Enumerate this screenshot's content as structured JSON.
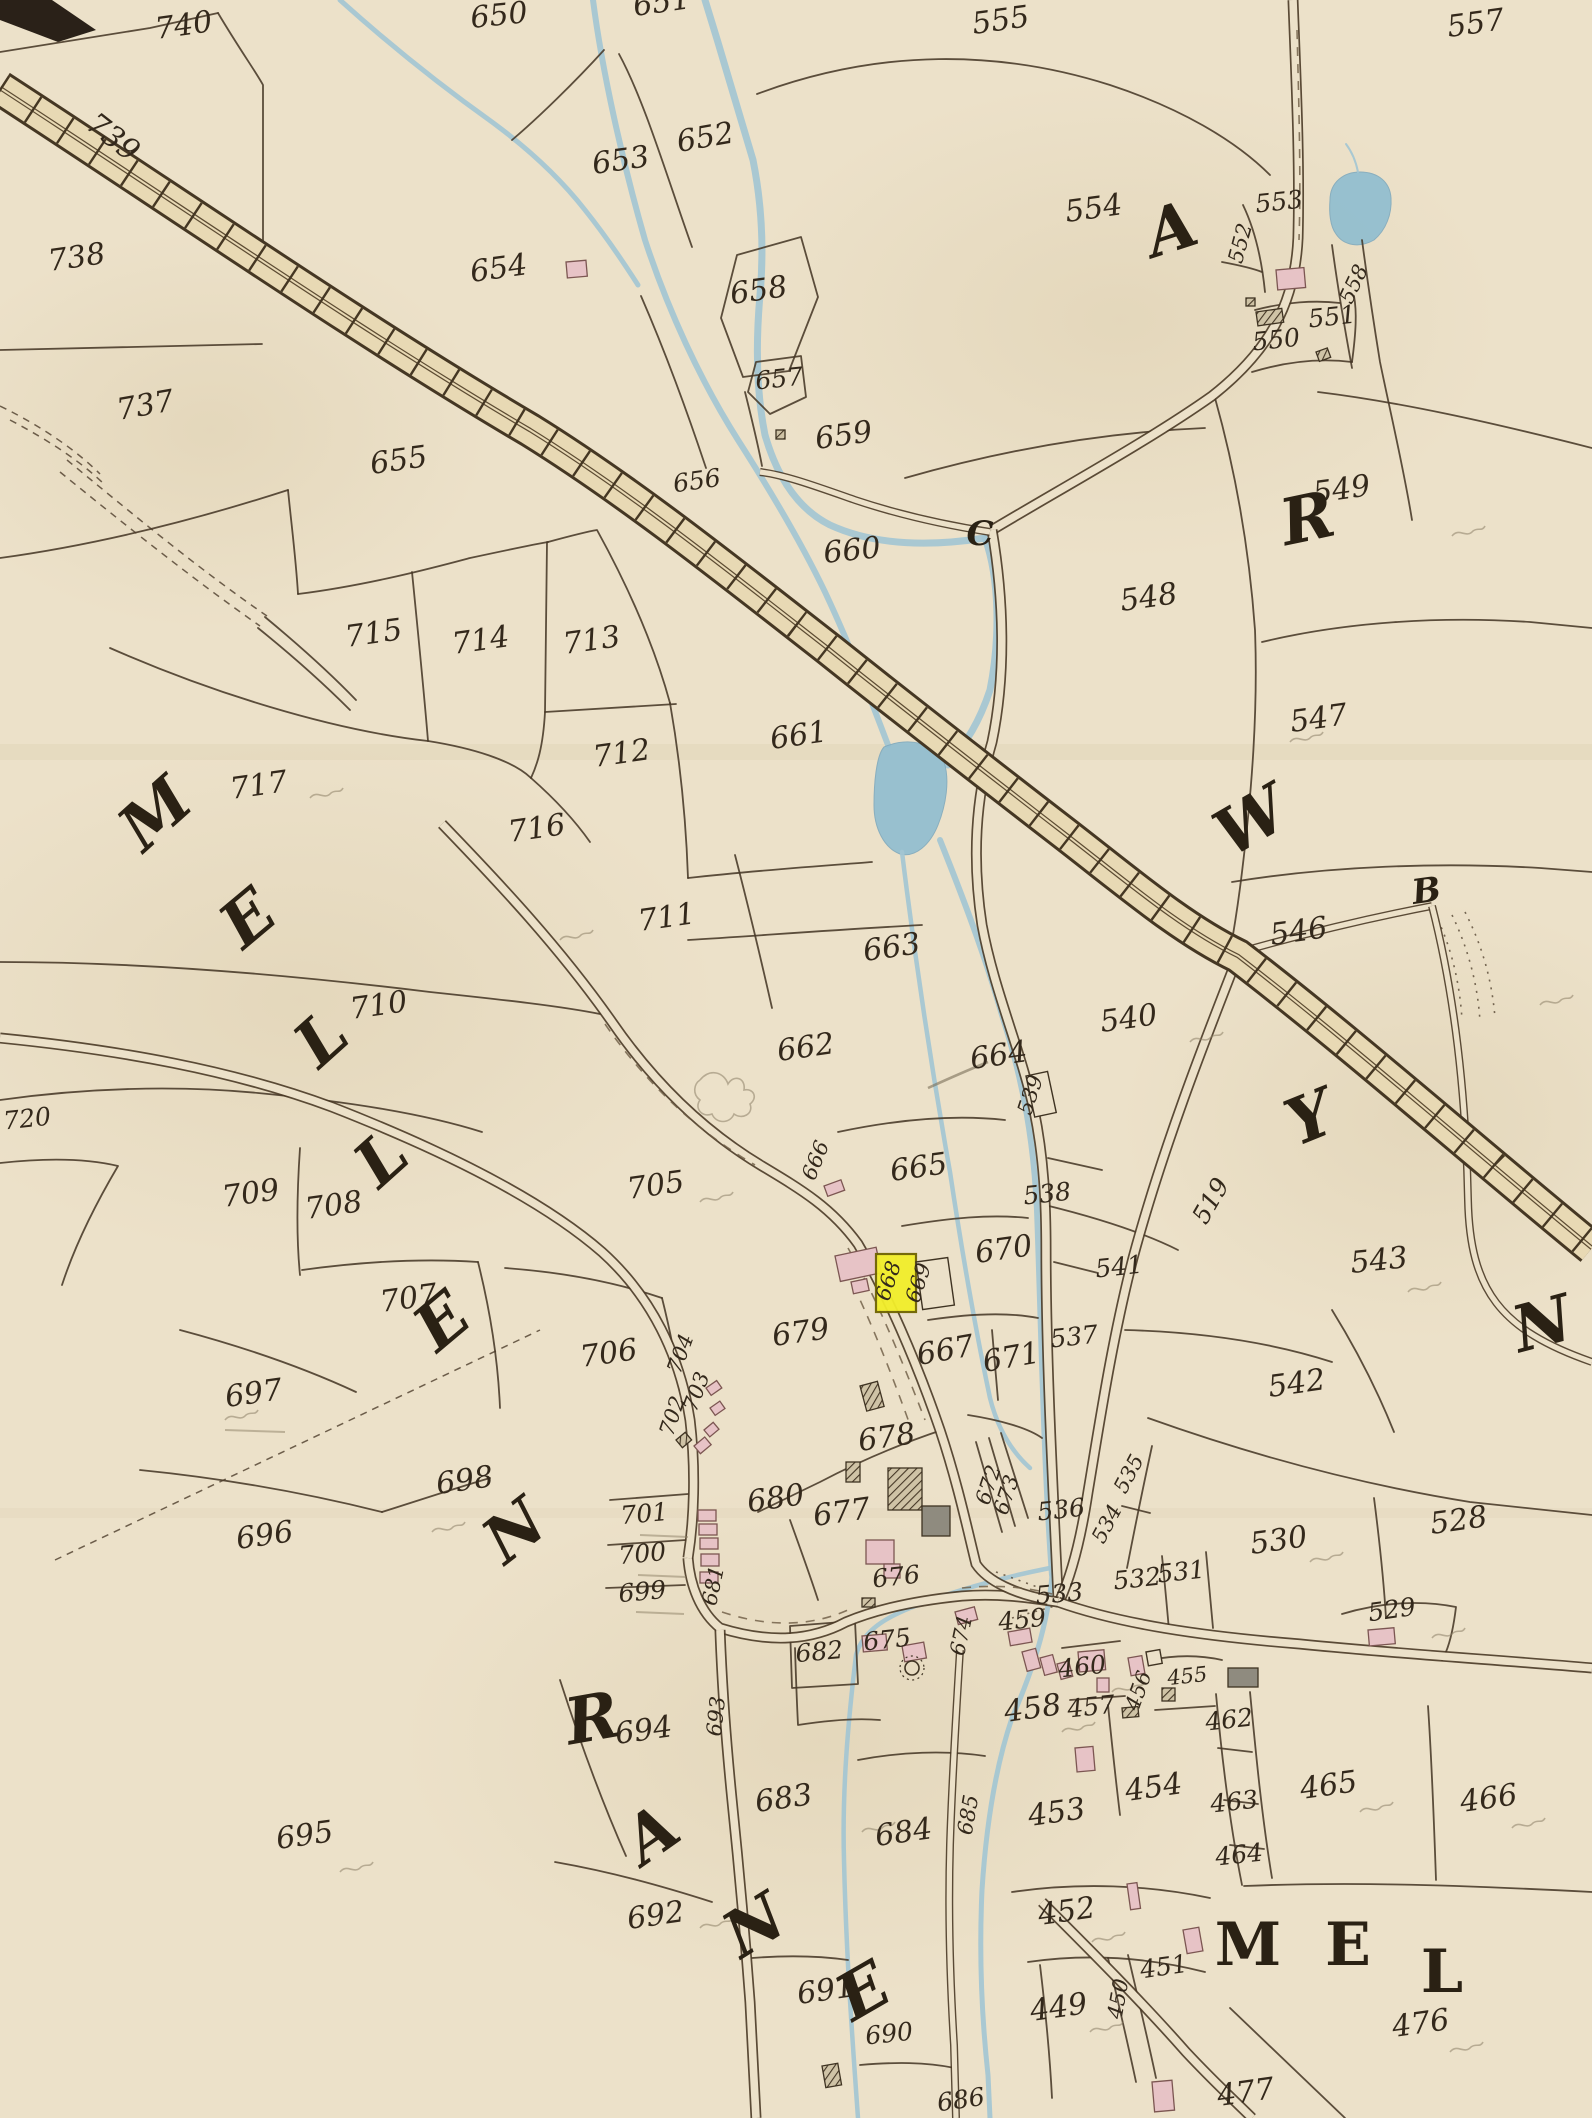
{
  "map": {
    "kind": "historical cadastral parish map",
    "colors": {
      "paper": "#ece1c9",
      "ink": "#473827",
      "water": "#a3c6d3",
      "railway_band": "#e8d9b4",
      "building_pink": "#e7c3c6",
      "highlight_yellow": "#f2ee2a"
    },
    "highlighted_parcel": "668",
    "labels": [
      [
        "740",
        185,
        35,
        -8
      ],
      [
        "739",
        107,
        145,
        38
      ],
      [
        "738",
        78,
        267,
        -8
      ],
      [
        "737",
        147,
        415,
        -10
      ],
      [
        "650",
        500,
        25,
        -6
      ],
      [
        "651",
        663,
        12,
        -8
      ],
      [
        "652",
        707,
        147,
        -10
      ],
      [
        "653",
        622,
        170,
        -8
      ],
      [
        "654",
        500,
        278,
        -8
      ],
      [
        "655",
        400,
        470,
        -8
      ],
      [
        "656",
        698,
        489,
        -8,
        "md"
      ],
      [
        "657",
        780,
        387,
        -6,
        "md"
      ],
      [
        "658",
        760,
        300,
        -8
      ],
      [
        "659",
        845,
        445,
        -8
      ],
      [
        "660",
        853,
        560,
        -6
      ],
      [
        "661",
        800,
        745,
        -8
      ],
      [
        "662",
        807,
        1057,
        -8
      ],
      [
        "663",
        893,
        957,
        -8
      ],
      [
        "664",
        1000,
        1065,
        -8
      ],
      [
        "665",
        920,
        1177,
        -8
      ],
      [
        "666",
        822,
        1163,
        -68,
        "sm"
      ],
      [
        "667",
        947,
        1360,
        -10
      ],
      [
        "668",
        895,
        1283,
        -72,
        "sm"
      ],
      [
        "669",
        925,
        1285,
        -72,
        "sm"
      ],
      [
        "670",
        1005,
        1259,
        -8
      ],
      [
        "671",
        1013,
        1367,
        -10
      ],
      [
        "672",
        995,
        1487,
        -72,
        "sm"
      ],
      [
        "673",
        1013,
        1497,
        -72,
        "sm"
      ],
      [
        "674",
        968,
        1637,
        -78,
        "sm"
      ],
      [
        "675",
        888,
        1648,
        -6,
        "md"
      ],
      [
        "676",
        897,
        1585,
        -6,
        "md"
      ],
      [
        "677",
        843,
        1522,
        -8
      ],
      [
        "678",
        888,
        1447,
        -8
      ],
      [
        "679",
        802,
        1342,
        -8
      ],
      [
        "680",
        777,
        1508,
        -8
      ],
      [
        "681",
        720,
        1587,
        -78,
        "sm"
      ],
      [
        "682",
        820,
        1660,
        -5,
        "md"
      ],
      [
        "683",
        785,
        1808,
        -8
      ],
      [
        "684",
        905,
        1842,
        -8
      ],
      [
        "685",
        975,
        1816,
        -80,
        "sm"
      ],
      [
        "686",
        962,
        2108,
        -8,
        "md"
      ],
      [
        "690",
        890,
        2042,
        -6,
        "md"
      ],
      [
        "691",
        827,
        2000,
        -8
      ],
      [
        "692",
        657,
        1925,
        -8
      ],
      [
        "693",
        723,
        1717,
        -84,
        "sm"
      ],
      [
        "694",
        645,
        1740,
        -8
      ],
      [
        "695",
        306,
        1845,
        -8
      ],
      [
        "696",
        266,
        1545,
        -8
      ],
      [
        "697",
        255,
        1403,
        -8
      ],
      [
        "698",
        466,
        1490,
        -8
      ],
      [
        "699",
        643,
        1600,
        -5,
        "md"
      ],
      [
        "700",
        643,
        1562,
        -5,
        "md"
      ],
      [
        "701",
        645,
        1522,
        -5,
        "md"
      ],
      [
        "702",
        679,
        1418,
        -72,
        "sm"
      ],
      [
        "703",
        703,
        1394,
        -70,
        "sm"
      ],
      [
        "704",
        687,
        1356,
        -70,
        "sm"
      ],
      [
        "705",
        657,
        1195,
        -8
      ],
      [
        "706",
        610,
        1363,
        -8
      ],
      [
        "707",
        410,
        1308,
        -8
      ],
      [
        "708",
        335,
        1215,
        -8
      ],
      [
        "709",
        252,
        1203,
        -8
      ],
      [
        "710",
        380,
        1015,
        -8
      ],
      [
        "711",
        668,
        927,
        -8
      ],
      [
        "712",
        623,
        763,
        -8
      ],
      [
        "713",
        593,
        650,
        -8
      ],
      [
        "714",
        482,
        650,
        -8
      ],
      [
        "715",
        375,
        643,
        -8
      ],
      [
        "716",
        538,
        838,
        -8
      ],
      [
        "717",
        260,
        795,
        -8
      ],
      [
        "720",
        28,
        1127,
        -6,
        "md"
      ],
      [
        "449",
        1060,
        2017,
        -8
      ],
      [
        "450",
        1125,
        2000,
        -80,
        "sm"
      ],
      [
        "451",
        1165,
        1975,
        -8,
        "md"
      ],
      [
        "452",
        1068,
        1921,
        -8
      ],
      [
        "453",
        1058,
        1822,
        -8
      ],
      [
        "454",
        1155,
        1797,
        -8
      ],
      [
        "455",
        1188,
        1683,
        -6,
        "sm"
      ],
      [
        "456",
        1145,
        1693,
        -70,
        "sm"
      ],
      [
        "457",
        1092,
        1715,
        -6,
        "md"
      ],
      [
        "458",
        1034,
        1718,
        -8
      ],
      [
        "459",
        1023,
        1628,
        -6,
        "md"
      ],
      [
        "460",
        1083,
        1675,
        -6,
        "md"
      ],
      [
        "462",
        1230,
        1728,
        -6,
        "md"
      ],
      [
        "463",
        1235,
        1810,
        -6,
        "md"
      ],
      [
        "464",
        1240,
        1863,
        -6,
        "md"
      ],
      [
        "465",
        1330,
        1795,
        -8
      ],
      [
        "466",
        1490,
        1808,
        -8
      ],
      [
        "476",
        1422,
        2033,
        -8
      ],
      [
        "477",
        1247,
        2102,
        -8
      ],
      [
        "519",
        1218,
        1205,
        -60,
        "md"
      ],
      [
        "528",
        1460,
        1530,
        -8
      ],
      [
        "529",
        1393,
        1618,
        -8,
        "md"
      ],
      [
        "530",
        1280,
        1550,
        -8
      ],
      [
        "531",
        1182,
        1580,
        -6,
        "md"
      ],
      [
        "532",
        1138,
        1587,
        -6,
        "md"
      ],
      [
        "533",
        1060,
        1602,
        -5,
        "md"
      ],
      [
        "534",
        1113,
        1527,
        -62,
        "sm"
      ],
      [
        "535",
        1135,
        1477,
        -62,
        "sm"
      ],
      [
        "536",
        1062,
        1518,
        -6,
        "md"
      ],
      [
        "537",
        1075,
        1345,
        -6,
        "md"
      ],
      [
        "538",
        1048,
        1202,
        -6,
        "md"
      ],
      [
        "539",
        1037,
        1097,
        -72,
        "sm"
      ],
      [
        "540",
        1130,
        1028,
        -8
      ],
      [
        "541",
        1120,
        1275,
        -6,
        "md"
      ],
      [
        "542",
        1298,
        1393,
        -8
      ],
      [
        "543",
        1380,
        1270,
        -6
      ],
      [
        "546",
        1300,
        941,
        -8
      ],
      [
        "547",
        1320,
        728,
        -8
      ],
      [
        "548",
        1150,
        607,
        -8
      ],
      [
        "549",
        1343,
        499,
        -8
      ],
      [
        "550",
        1277,
        348,
        -6,
        "md"
      ],
      [
        "551",
        1333,
        325,
        -6,
        "md"
      ],
      [
        "552",
        1247,
        245,
        -75,
        "sm"
      ],
      [
        "553",
        1280,
        210,
        -6,
        "md"
      ],
      [
        "554",
        1095,
        218,
        -8
      ],
      [
        "555",
        1002,
        30,
        -8
      ],
      [
        "557",
        1477,
        33,
        -8
      ],
      [
        "558",
        1360,
        287,
        -65,
        "sm"
      ],
      [
        "A",
        1178,
        250,
        -18,
        "L"
      ],
      [
        "R",
        1312,
        540,
        -12,
        "L"
      ],
      [
        "W",
        1262,
        840,
        -30,
        "L"
      ],
      [
        "Y",
        1318,
        1138,
        -22,
        "L"
      ],
      [
        "N",
        1548,
        1345,
        -15,
        "L"
      ],
      [
        "M",
        170,
        830,
        -42,
        "L"
      ],
      [
        "E",
        262,
        935,
        -40,
        "L"
      ],
      [
        "L",
        336,
        1055,
        -42,
        "L"
      ],
      [
        "L",
        396,
        1175,
        -42,
        "L"
      ],
      [
        "E",
        456,
        1338,
        -40,
        "L"
      ],
      [
        "N",
        528,
        1548,
        -38,
        "L"
      ],
      [
        "R",
        596,
        1740,
        -10,
        "L"
      ],
      [
        "A",
        664,
        1852,
        -35,
        "L"
      ],
      [
        "N",
        766,
        1944,
        -32,
        "L"
      ],
      [
        "E",
        874,
        2010,
        -30,
        "L"
      ],
      [
        "M",
        1248,
        1965,
        0,
        "LU"
      ],
      [
        "E",
        1348,
        1965,
        0,
        "LU"
      ],
      [
        "L",
        1442,
        1992,
        0,
        "LU"
      ],
      [
        "C",
        980,
        545,
        0,
        "Ls"
      ],
      [
        "B",
        1428,
        902,
        -8,
        "Ls"
      ]
    ],
    "buildings": [
      [
        "p",
        566,
        262,
        20,
        16,
        -5
      ],
      [
        "p",
        1276,
        270,
        28,
        20,
        -5
      ],
      [
        "h",
        1256,
        312,
        26,
        14,
        -8
      ],
      [
        "h",
        1246,
        298,
        9,
        8,
        0
      ],
      [
        "h",
        1316,
        352,
        12,
        10,
        -20
      ],
      [
        "h",
        776,
        430,
        9,
        9,
        0
      ],
      [
        "p",
        824,
        1186,
        18,
        11,
        -20
      ],
      [
        "p",
        835,
        1256,
        42,
        26,
        -12
      ],
      [
        "p",
        851,
        1282,
        16,
        12,
        -12
      ],
      [
        "y",
        876,
        1254,
        40,
        58,
        0
      ],
      [
        "o",
        916,
        1262,
        32,
        48,
        -8
      ],
      [
        "o",
        1026,
        1076,
        22,
        42,
        -12
      ],
      [
        "p",
        706,
        1388,
        13,
        9,
        -35
      ],
      [
        "p",
        710,
        1408,
        12,
        9,
        -35
      ],
      [
        "p",
        704,
        1430,
        12,
        9,
        -40
      ],
      [
        "p",
        694,
        1446,
        14,
        10,
        -40
      ],
      [
        "h",
        676,
        1440,
        12,
        10,
        -40
      ],
      [
        "p",
        698,
        1510,
        18,
        11,
        0
      ],
      [
        "p",
        699,
        1524,
        18,
        11,
        0
      ],
      [
        "p",
        700,
        1538,
        18,
        11,
        0
      ],
      [
        "p",
        701,
        1554,
        18,
        12,
        0
      ],
      [
        "p",
        700,
        1572,
        18,
        11,
        0
      ],
      [
        "h",
        860,
        1386,
        18,
        26,
        -15
      ],
      [
        "h",
        888,
        1468,
        34,
        42,
        0
      ],
      [
        "g",
        922,
        1506,
        28,
        30,
        0
      ],
      [
        "h",
        846,
        1462,
        14,
        20,
        0
      ],
      [
        "p",
        866,
        1540,
        28,
        24,
        0
      ],
      [
        "p",
        884,
        1564,
        16,
        14,
        0
      ],
      [
        "h",
        862,
        1598,
        13,
        9,
        0
      ],
      [
        "p",
        862,
        1636,
        24,
        16,
        -5
      ],
      [
        "p",
        902,
        1646,
        22,
        16,
        -10
      ],
      [
        "p",
        955,
        1612,
        20,
        13,
        -15
      ],
      [
        "p",
        1008,
        1632,
        22,
        14,
        -10
      ],
      [
        "p",
        1022,
        1652,
        14,
        20,
        -15
      ],
      [
        "p",
        1040,
        1658,
        13,
        18,
        -15
      ],
      [
        "p",
        1057,
        1664,
        12,
        16,
        -15
      ],
      [
        "p",
        1078,
        1652,
        26,
        20,
        -5
      ],
      [
        "p",
        1097,
        1678,
        12,
        14,
        0
      ],
      [
        "p",
        1128,
        1658,
        14,
        18,
        -10
      ],
      [
        "o",
        1146,
        1652,
        14,
        14,
        -10
      ],
      [
        "h",
        1162,
        1688,
        13,
        13,
        0
      ],
      [
        "h",
        1122,
        1708,
        16,
        10,
        -5
      ],
      [
        "g",
        1228,
        1668,
        30,
        19,
        0
      ],
      [
        "p",
        1368,
        1630,
        26,
        16,
        -5
      ],
      [
        "p",
        1075,
        1748,
        18,
        24,
        -5
      ],
      [
        "p",
        1127,
        1884,
        10,
        26,
        -8
      ],
      [
        "p",
        1183,
        1930,
        16,
        24,
        -10
      ],
      [
        "p",
        1152,
        2082,
        20,
        30,
        -5
      ],
      [
        "h",
        822,
        2066,
        16,
        22,
        -10
      ]
    ],
    "pencil": {
      "marks": [
        [
          310,
          798
        ],
        [
          700,
          1202
        ],
        [
          1408,
          1292
        ],
        [
          1310,
          1562
        ],
        [
          1432,
          1638
        ],
        [
          1360,
          1812
        ],
        [
          1512,
          1828
        ],
        [
          1450,
          2052
        ],
        [
          1092,
          1942
        ],
        [
          1090,
          2032
        ],
        [
          432,
          1532
        ],
        [
          340,
          1872
        ],
        [
          1062,
          1732
        ],
        [
          1112,
          1692
        ],
        [
          862,
          1832
        ],
        [
          700,
          1928
        ],
        [
          225,
          1420
        ],
        [
          1190,
          1042
        ],
        [
          560,
          940
        ],
        [
          1290,
          742
        ],
        [
          1452,
          536
        ],
        [
          1540,
          1005
        ]
      ],
      "underlines": [
        [
          640,
          1535,
          48
        ],
        [
          638,
          1575,
          48
        ],
        [
          636,
          1612,
          48
        ],
        [
          225,
          1430,
          60
        ]
      ]
    }
  }
}
